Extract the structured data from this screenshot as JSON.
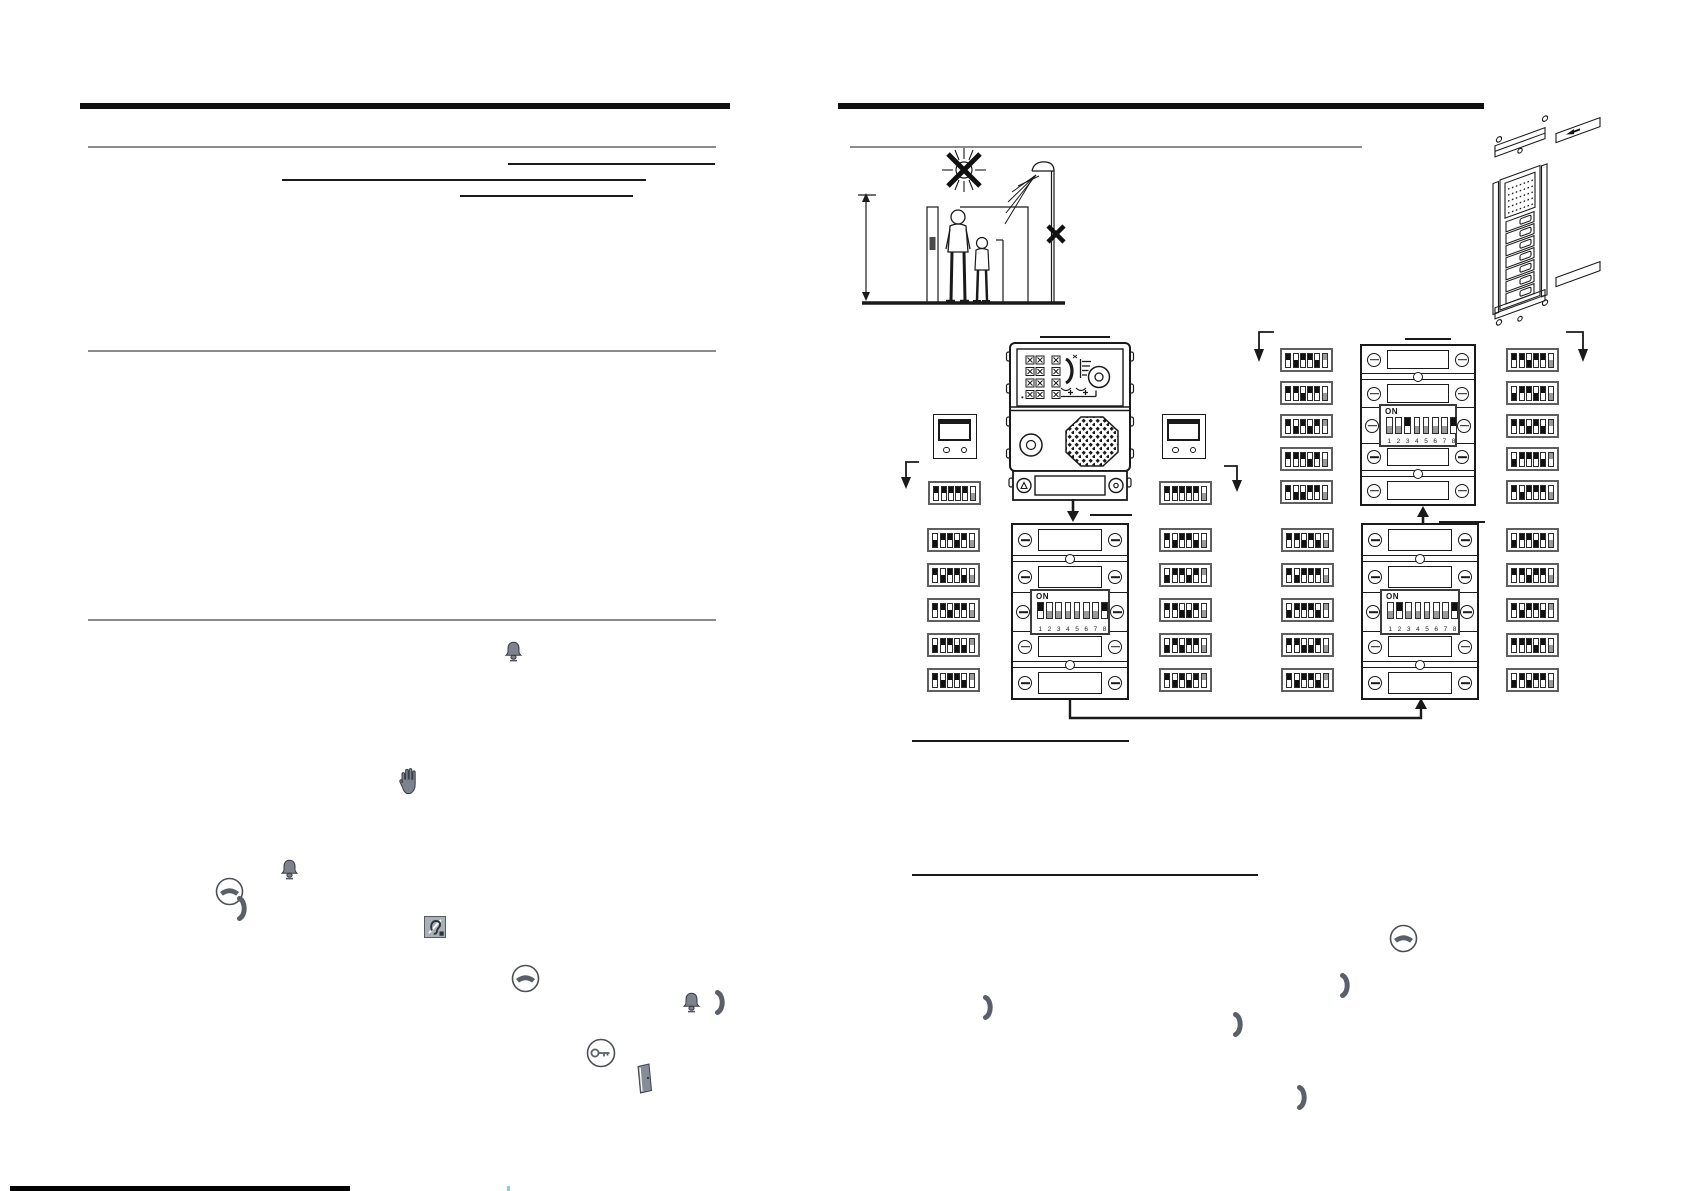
{
  "document": {
    "kind": "intercom installation manual page (two columns, text redacted)",
    "colors": {
      "ink": "#1a1a1a",
      "gray_rule": "#8b8b8b",
      "icon_gray": "#7d838c",
      "switch_on": "#111111",
      "switch_off": "#9a9a9a"
    },
    "visible_text_strings": [
      "ON",
      "1 2 3 4 5 6 7 8"
    ]
  },
  "dip": {
    "on_label": "ON",
    "numbers": [
      "1",
      "2",
      "3",
      "4",
      "5",
      "6",
      "7",
      "8"
    ],
    "big_patterns": {
      "g1": [
        1,
        0,
        0,
        0,
        0,
        0,
        0,
        1
      ],
      "g2": [
        0,
        0,
        1,
        0,
        0,
        0,
        0,
        1
      ],
      "g4": [
        0,
        1,
        0,
        0,
        0,
        0,
        0,
        1
      ]
    },
    "small_patterns": {
      "under_left": [
        1,
        1,
        1,
        1,
        1,
        0
      ],
      "under_right": [
        1,
        1,
        1,
        1,
        1,
        0
      ],
      "g2_left": [
        [
          1,
          0,
          1,
          1,
          0,
          1
        ],
        [
          1,
          1,
          0,
          1,
          1,
          0
        ],
        [
          1,
          0,
          1,
          0,
          1,
          1
        ],
        [
          1,
          1,
          1,
          0,
          1,
          0
        ],
        [
          1,
          0,
          0,
          1,
          1,
          0
        ]
      ],
      "g2_right": [
        [
          1,
          1,
          0,
          1,
          1,
          0
        ],
        [
          0,
          1,
          1,
          0,
          1,
          0
        ],
        [
          1,
          1,
          0,
          1,
          0,
          1
        ],
        [
          0,
          1,
          1,
          1,
          0,
          1
        ],
        [
          1,
          0,
          1,
          1,
          1,
          0
        ]
      ],
      "g1_left": [
        [
          0,
          1,
          1,
          0,
          1,
          0
        ],
        [
          1,
          0,
          1,
          1,
          0,
          0
        ],
        [
          1,
          1,
          0,
          1,
          1,
          0
        ],
        [
          0,
          1,
          1,
          0,
          0,
          1
        ],
        [
          1,
          0,
          1,
          1,
          0,
          1
        ]
      ],
      "g1_right": [
        [
          1,
          0,
          1,
          1,
          0,
          0
        ],
        [
          0,
          1,
          1,
          0,
          1,
          1
        ],
        [
          1,
          1,
          0,
          0,
          1,
          0
        ],
        [
          0,
          1,
          0,
          1,
          1,
          0
        ],
        [
          1,
          0,
          1,
          0,
          1,
          1
        ]
      ],
      "g4_left": [
        [
          1,
          1,
          0,
          1,
          0,
          0
        ],
        [
          1,
          0,
          1,
          1,
          1,
          0
        ],
        [
          0,
          1,
          1,
          1,
          0,
          1
        ],
        [
          1,
          1,
          0,
          0,
          1,
          0
        ],
        [
          1,
          0,
          1,
          1,
          0,
          1
        ]
      ],
      "g4_right": [
        [
          0,
          1,
          1,
          0,
          1,
          0
        ],
        [
          1,
          1,
          0,
          1,
          1,
          0
        ],
        [
          1,
          0,
          1,
          1,
          0,
          1
        ],
        [
          1,
          1,
          1,
          0,
          1,
          0
        ],
        [
          0,
          1,
          0,
          1,
          1,
          0
        ]
      ]
    }
  },
  "left_column_icons": [
    {
      "name": "bell-icon",
      "x": 504,
      "y": 641
    },
    {
      "name": "stop-hand-icon",
      "x": 397,
      "y": 768
    },
    {
      "name": "bell-icon",
      "x": 280,
      "y": 859
    },
    {
      "name": "phone-hangup-circle-icon",
      "x": 215,
      "y": 877
    },
    {
      "name": "handset-icon",
      "x": 236,
      "y": 896
    },
    {
      "name": "hearing-aid-icon",
      "x": 424,
      "y": 916
    },
    {
      "name": "phone-hangup-circle-icon",
      "x": 511,
      "y": 964
    },
    {
      "name": "bell-icon",
      "x": 682,
      "y": 992
    },
    {
      "name": "handset-icon",
      "x": 714,
      "y": 990
    },
    {
      "name": "key-circle-icon",
      "x": 586,
      "y": 1038
    },
    {
      "name": "door-icon",
      "x": 635,
      "y": 1063
    }
  ],
  "right_column_icons": [
    {
      "name": "phone-hangup-circle-icon",
      "x": 1389,
      "y": 924
    },
    {
      "name": "handset-icon",
      "x": 1339,
      "y": 973
    },
    {
      "name": "handset-icon",
      "x": 982,
      "y": 995
    },
    {
      "name": "handset-icon",
      "x": 1232,
      "y": 1012
    },
    {
      "name": "handset-icon",
      "x": 1296,
      "y": 1085
    }
  ]
}
